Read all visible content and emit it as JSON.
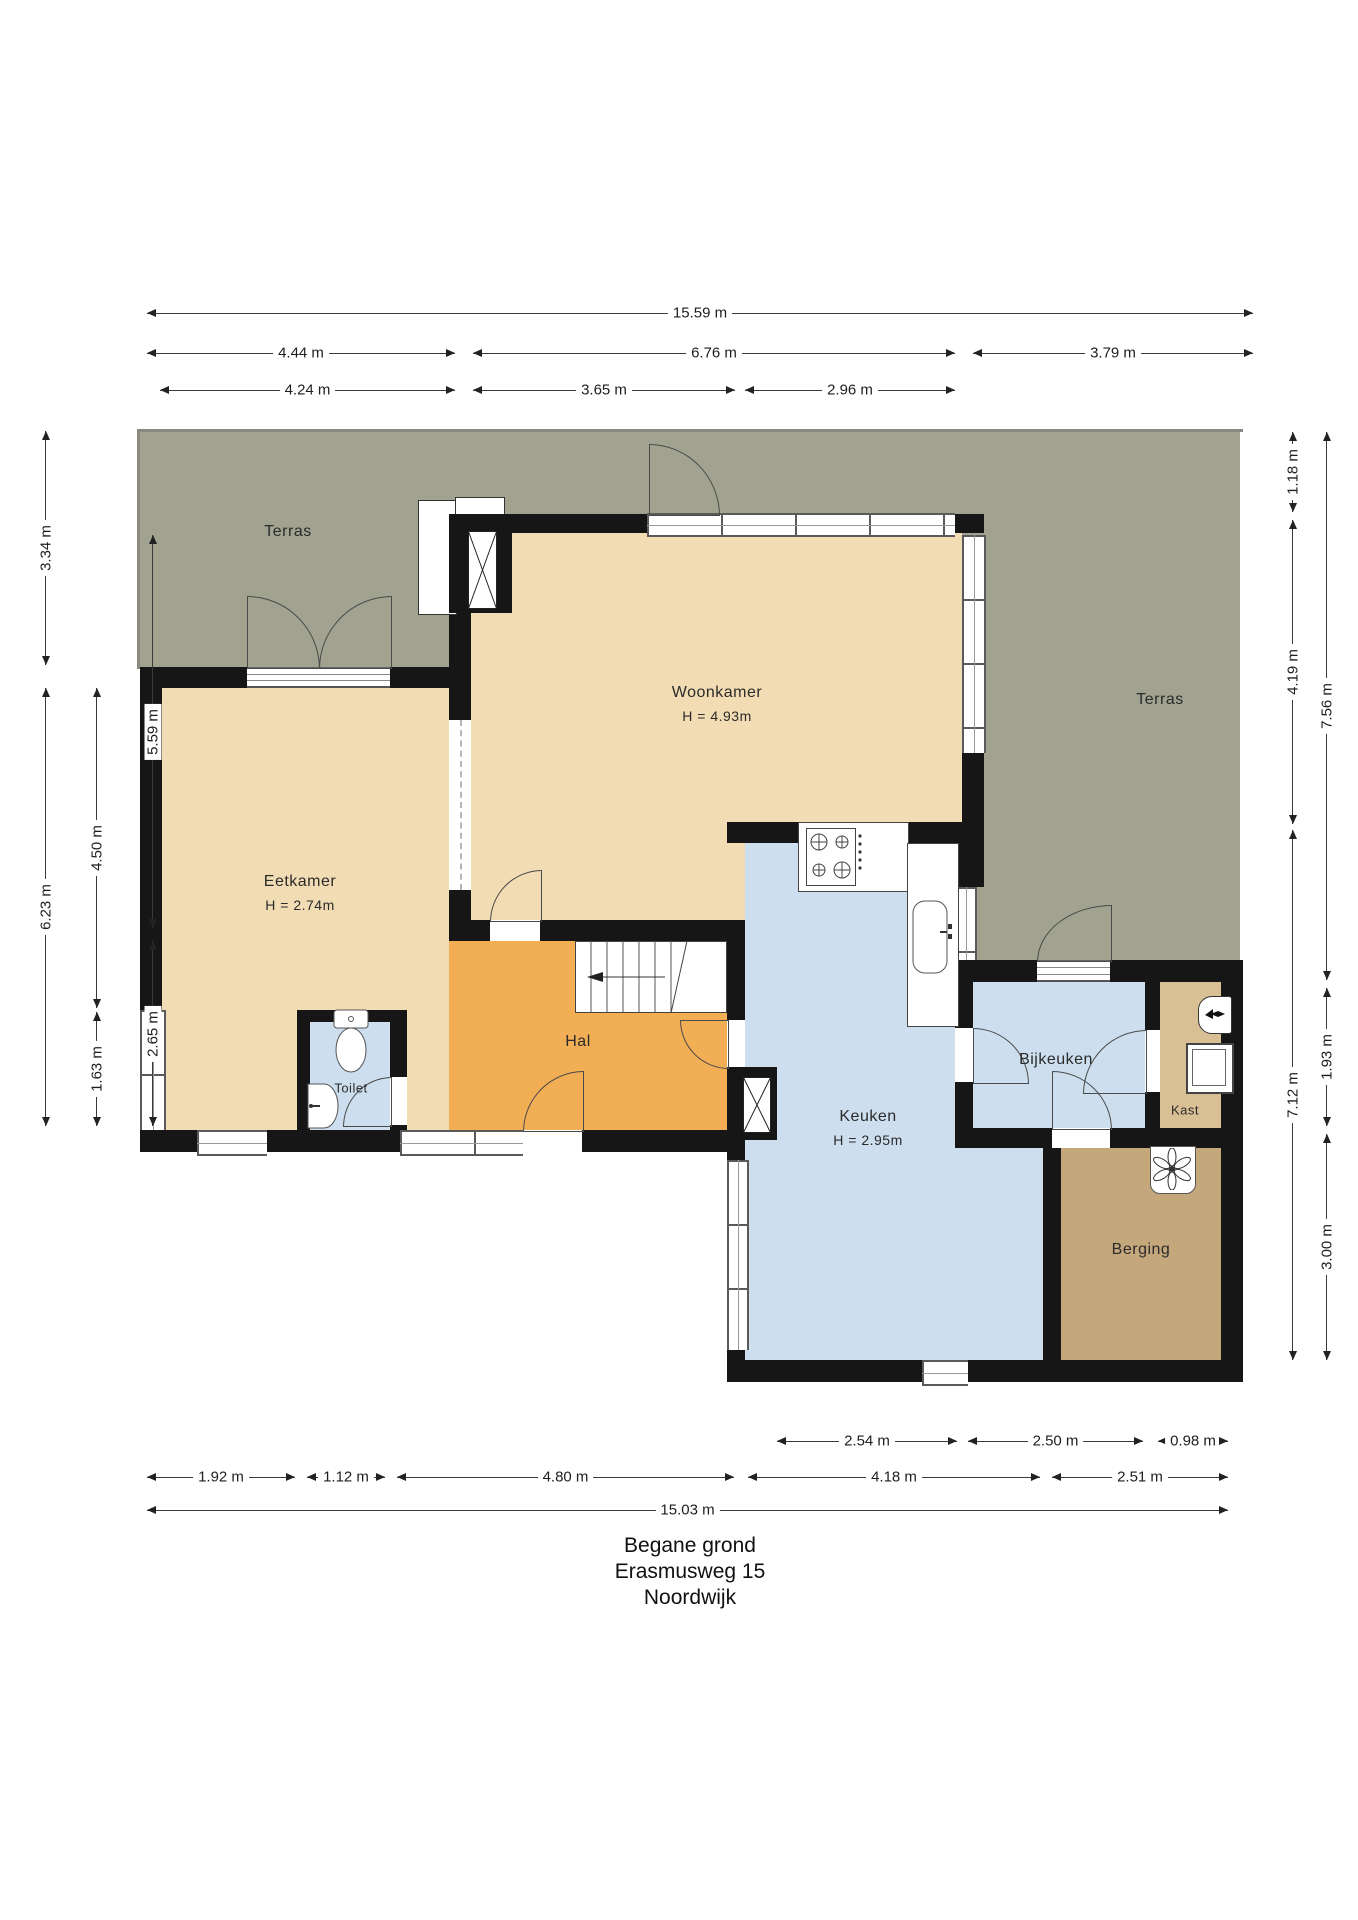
{
  "title": {
    "line1": "Begane grond",
    "line2": "Erasmusweg 15",
    "line3": "Noordwijk"
  },
  "rooms": {
    "terras_left": {
      "label": "Terras"
    },
    "terras_right": {
      "label": "Terras"
    },
    "woonkamer": {
      "label": "Woonkamer",
      "height": "H = 4.93m"
    },
    "eetkamer": {
      "label": "Eetkamer",
      "height": "H = 2.74m"
    },
    "hal": {
      "label": "Hal"
    },
    "toilet": {
      "label": "Toilet"
    },
    "keuken": {
      "label": "Keuken",
      "height": "H = 2.95m"
    },
    "bijkeuken": {
      "label": "Bijkeuken"
    },
    "kast": {
      "label": "Kast"
    },
    "berging": {
      "label": "Berging"
    }
  },
  "dimensions": {
    "top": [
      {
        "label": "15.59 m"
      },
      {
        "label": "4.44 m"
      },
      {
        "label": "6.76 m"
      },
      {
        "label": "3.79 m"
      },
      {
        "label": "4.24 m"
      },
      {
        "label": "3.65 m"
      },
      {
        "label": "2.96 m"
      }
    ],
    "bottom": [
      {
        "label": "2.54 m"
      },
      {
        "label": "2.50 m"
      },
      {
        "label": "0.98 m"
      },
      {
        "label": "1.92 m"
      },
      {
        "label": "1.12 m"
      },
      {
        "label": "4.80 m"
      },
      {
        "label": "4.18 m"
      },
      {
        "label": "2.51 m"
      },
      {
        "label": "15.03 m"
      }
    ],
    "left": [
      {
        "label": "3.34 m"
      },
      {
        "label": "6.23 m"
      },
      {
        "label": "4.50 m"
      },
      {
        "label": "1.63 m"
      },
      {
        "label": "5.59 m"
      },
      {
        "label": "2.65 m"
      }
    ],
    "right": [
      {
        "label": "1.18 m"
      },
      {
        "label": "4.19 m"
      },
      {
        "label": "7.12 m"
      },
      {
        "label": "7.56 m"
      },
      {
        "label": "1.93 m"
      },
      {
        "label": "3.00 m"
      }
    ]
  },
  "colors": {
    "terras": "#a1a390",
    "floor_beige": "#f2dcb3",
    "hal_orange": "#f2ae55",
    "wet_room_blue": "#cddeee",
    "kast_tan": "#d9bf94",
    "berging_tan": "#c5a77c",
    "wall": "#161616"
  }
}
